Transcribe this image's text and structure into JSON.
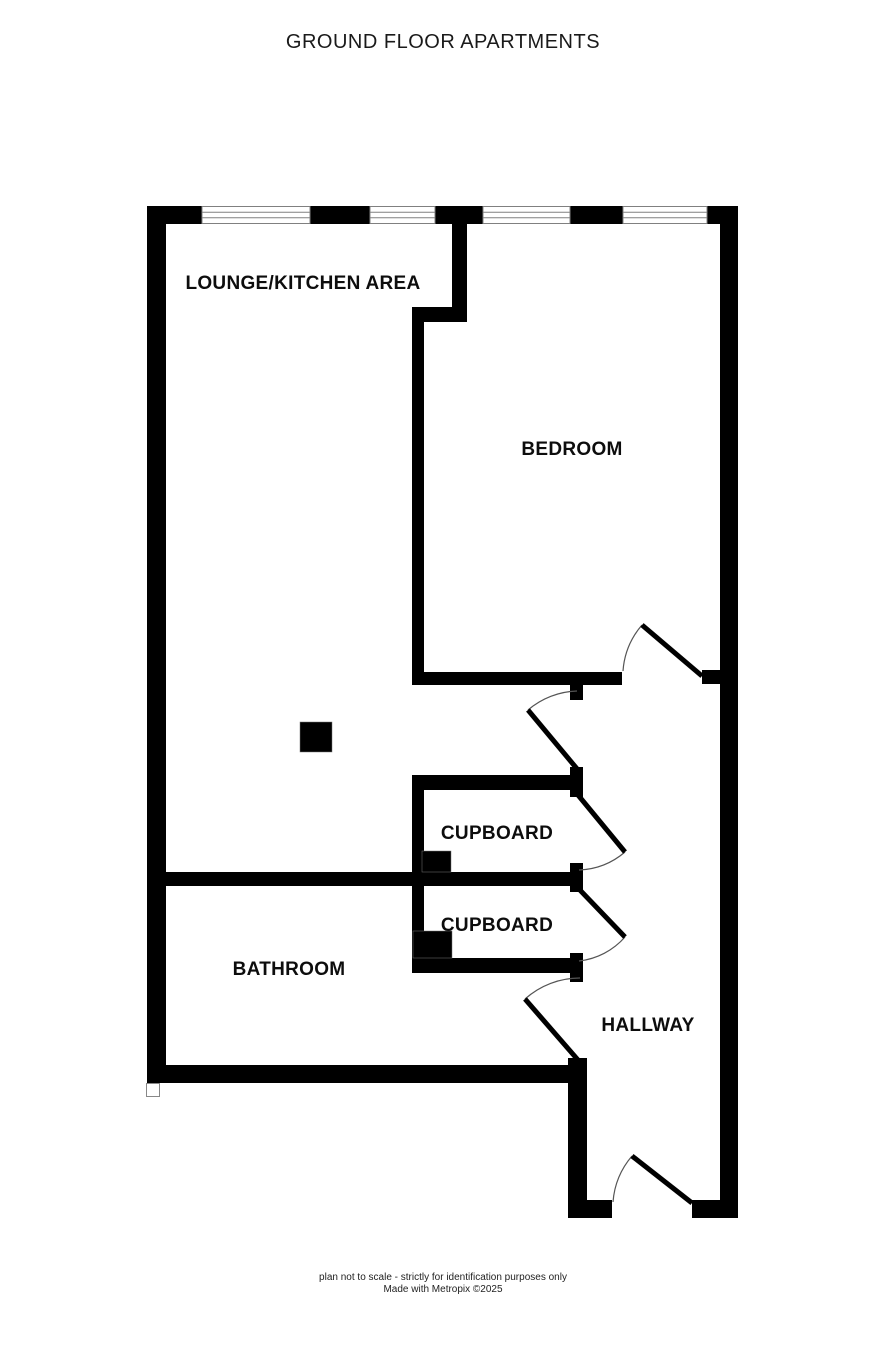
{
  "title": "GROUND FLOOR APARTMENTS",
  "rooms": {
    "lounge_kitchen": "LOUNGE/KITCHEN AREA",
    "bedroom": "BEDROOM",
    "cupboard_top": "CUPBOARD",
    "cupboard_bottom": "CUPBOARD",
    "bathroom": "BATHROOM",
    "hallway": "HALLWAY"
  },
  "footer": {
    "disclaimer": "plan not to scale - strictly for identification purposes only",
    "credit": "Made with Metropix ©2025"
  },
  "colors": {
    "wall": "#000000",
    "background": "#ffffff",
    "window_frame": "#808080",
    "door_arc": "#555555"
  }
}
